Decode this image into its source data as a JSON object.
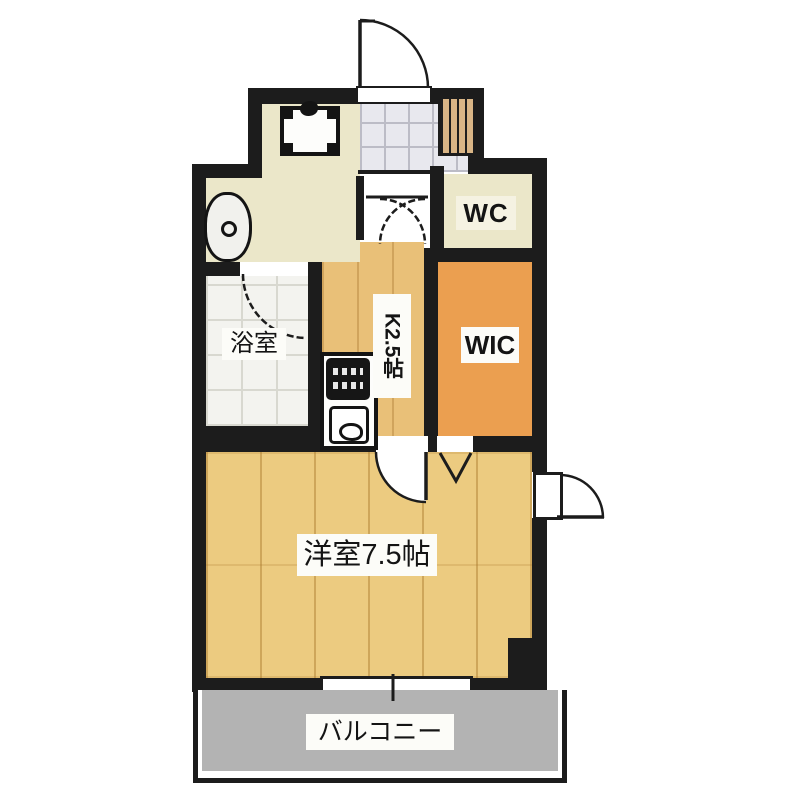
{
  "rooms": {
    "bathroom": {
      "label": "浴室"
    },
    "toilet": {
      "label": "WC"
    },
    "walk_in_closet": {
      "label": "WIC"
    },
    "kitchen": {
      "label": "K2.5帖"
    },
    "western_room": {
      "label": "洋室7.5帖"
    },
    "balcony": {
      "label": "バルコニー"
    }
  },
  "fixtures": [
    "entrance-door",
    "shoe-cabinet",
    "entry-tile",
    "washing-machine-pan",
    "washbasin",
    "bathroom-door",
    "hall-folding-door",
    "kitchen-counter",
    "gas-stove",
    "kitchen-sink",
    "room-door",
    "wic-folding-door",
    "service-door",
    "window",
    "pillar",
    "balcony-rail"
  ],
  "colors": {
    "wall": "#1c1c1c",
    "hall_floor": "#ebe7c9",
    "entry_tile": "#e8e8ee",
    "bathroom_floor": "#f3f3ef",
    "kitchen_floor": "#e9c078",
    "main_room_floor": "#eccb80",
    "wic_floor": "#eb9f50",
    "wc_floor": "#ebe7c9",
    "balcony_floor": "#b3b3b3",
    "shoe_cabinet": "#d9b586"
  }
}
